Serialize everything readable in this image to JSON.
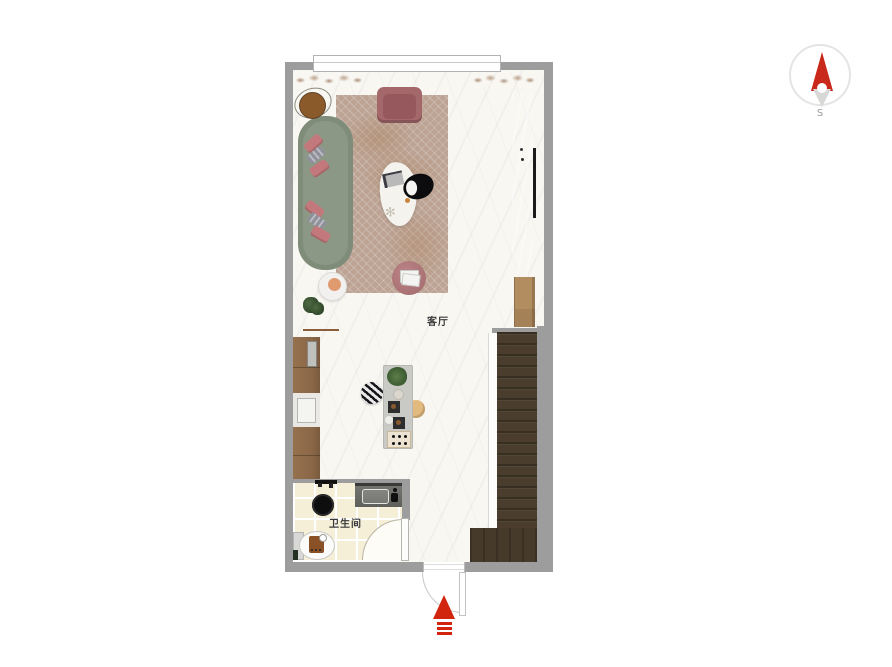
{
  "scene": {
    "type": "apartment-floor-plan"
  },
  "compass": {
    "south_label": "S",
    "north_color": "#c8291b",
    "south_color": "#d8d8d6",
    "ring_color": "#e4e4e4"
  },
  "floorplan": {
    "labels": {
      "living_room": "客厅",
      "bathroom": "卫生间"
    },
    "entrance": {
      "arrow_color": "#d2250e"
    },
    "colors": {
      "wall": "#9d9d9d",
      "floor": "#f9f7f2",
      "rug": "#bca394",
      "sofa_green": "#8b9886",
      "pillow_pink": "#c3797c",
      "armchair_pink": "#a4686b",
      "ottoman_pink": "#ad787a",
      "stairs_brown": "#4a3d2d",
      "wood_cabinet": "#b28d5f",
      "kitchen_cabinet": "#8d6b4c",
      "island_gray": "#c9c9c5",
      "marble_wardrobe": "#cdcdcb",
      "bathroom_tile": "#f5efd8",
      "stool_tan": "#e3ba7e"
    }
  },
  "icons": {
    "flower_sprig": "✻"
  }
}
